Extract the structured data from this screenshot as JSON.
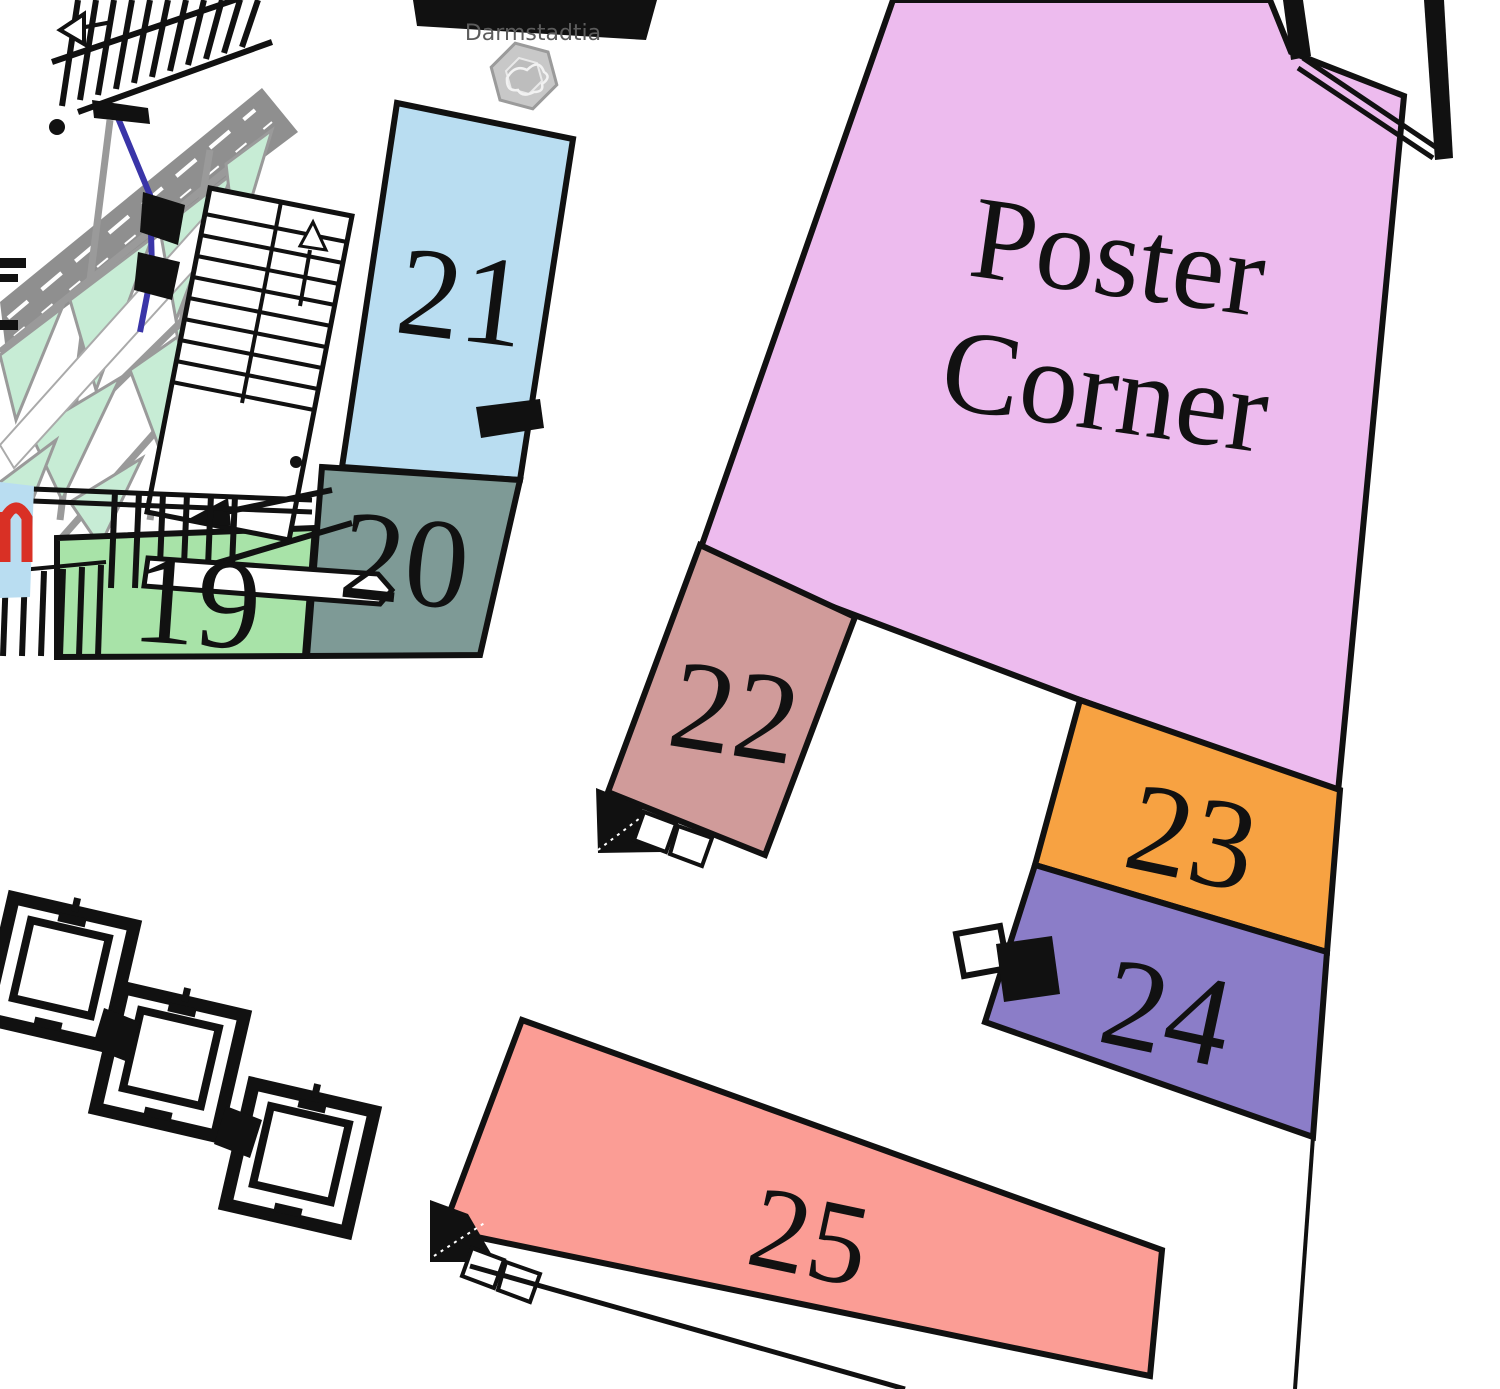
{
  "map": {
    "venue_label": "Darmstadtia",
    "poster_area": {
      "id": "poster-corner",
      "label_line1": "Poster",
      "label_line2": "Corner",
      "color": "#edbbee"
    },
    "booths": [
      {
        "id": "19",
        "label": "19",
        "color": "#a8e3a8"
      },
      {
        "id": "20",
        "label": "20",
        "color": "#7e9a96"
      },
      {
        "id": "21",
        "label": "21",
        "color": "#b9ddf1"
      },
      {
        "id": "22",
        "label": "22",
        "color": "#d09b9a"
      },
      {
        "id": "23",
        "label": "23",
        "color": "#f7a242"
      },
      {
        "id": "24",
        "label": "24",
        "color": "#8b7dc8"
      },
      {
        "id": "25",
        "label": "25",
        "color": "#fb9d95"
      }
    ],
    "colors": {
      "wall": "#111111",
      "walkway_gray": "#8f8f8f",
      "truss_mint": "#c7ecd5",
      "accent_blue": "#3a35a8",
      "logo_gray": "#c8c8c8",
      "venue_text": "#5c5c5c",
      "highlight_red": "#d93025",
      "edge_booth_blue": "#b9ddf1"
    }
  }
}
